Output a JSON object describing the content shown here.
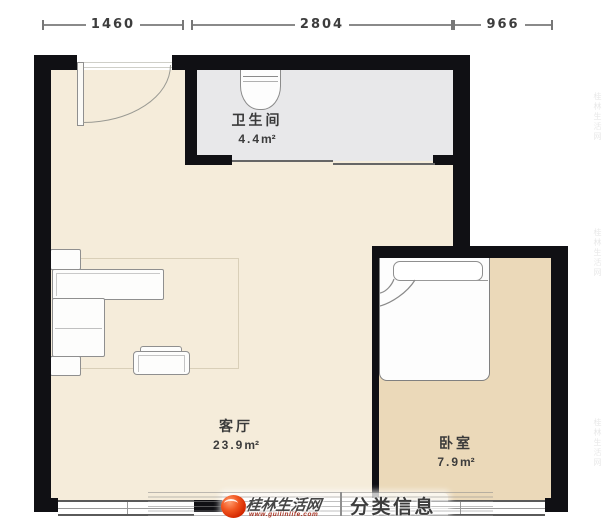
{
  "dimension_bar": {
    "segments": [
      {
        "label": "1460"
      },
      {
        "label": "2804"
      },
      {
        "label": "966"
      }
    ]
  },
  "rooms": {
    "bathroom": {
      "name": "卫生间",
      "area": "4.4",
      "unit": "m²"
    },
    "living": {
      "name": "客厅",
      "area": "23.9",
      "unit": "m²"
    },
    "bedroom": {
      "name": "卧室",
      "area": "7.9",
      "unit": "m²"
    }
  },
  "watermark": {
    "site": "桂林生活网",
    "url": "www.guilinlife.com",
    "divider": "|",
    "category": "分类信息",
    "edge_mark": "桂林生活网"
  },
  "colors": {
    "wall": "#101014",
    "living_floor": "#f5ecda",
    "bedroom_floor": "#ebd9b9",
    "bathroom_floor": "#e8e8ea",
    "logo_red": "#e23a10",
    "dimension_text": "#3d3d3d"
  }
}
